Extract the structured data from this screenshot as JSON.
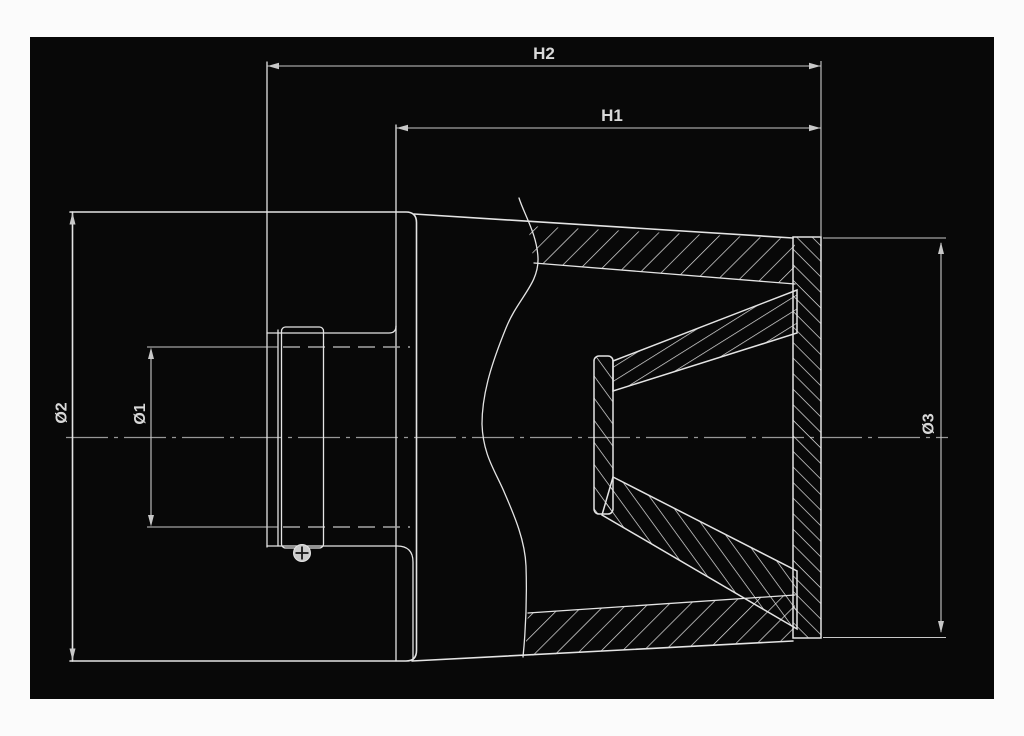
{
  "labels": {
    "h2": "H2",
    "h1": "H1",
    "d1": "Ø1",
    "d2": "Ø2",
    "d3": "Ø3"
  },
  "colors": {
    "canvas": "#080808",
    "page": "#fbfbfb",
    "line": "#e4e4e4",
    "dim": "#c8c8c8",
    "hidden": "#a6a6a6",
    "center": "#989898",
    "text": "#d9d9d9",
    "screw": "#cccccc"
  }
}
